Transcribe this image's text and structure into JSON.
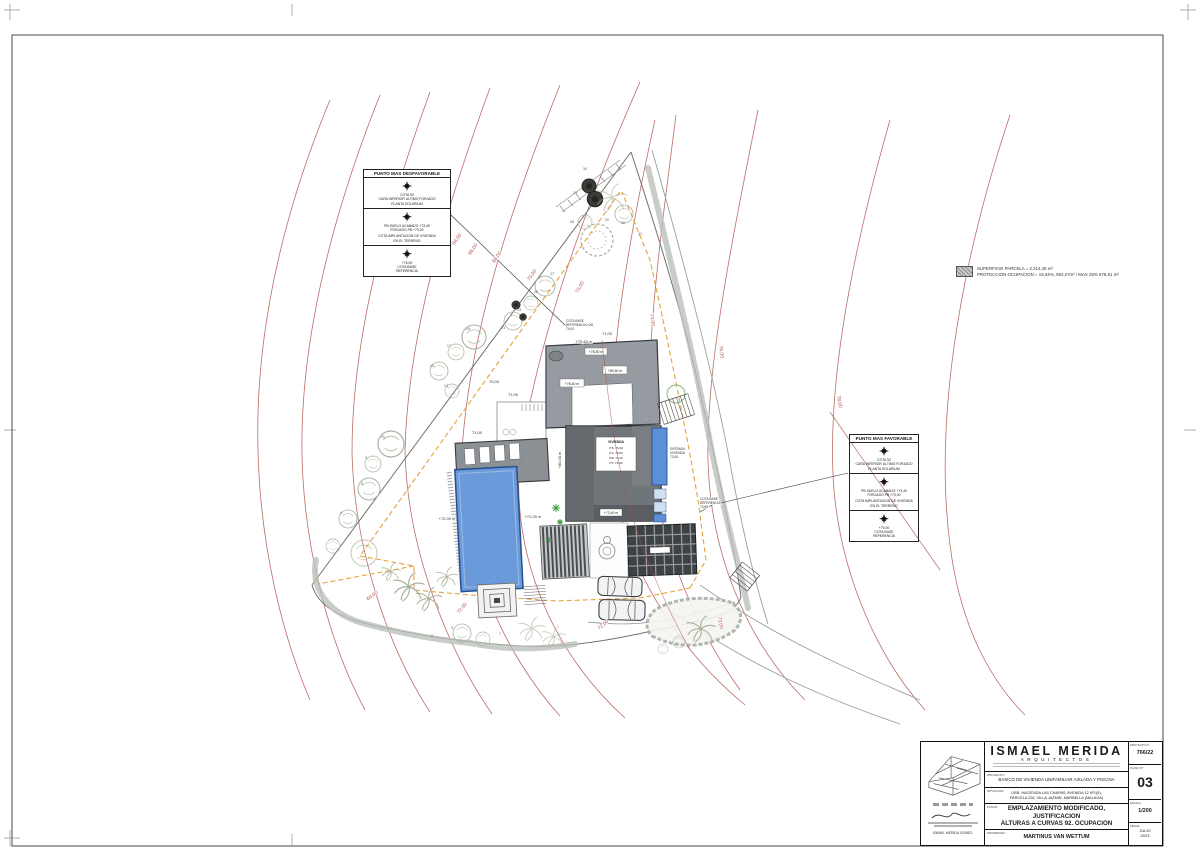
{
  "sheet": {
    "legend": {
      "line1": "SUPERFICIE PARCELA = 2.314,45 m²",
      "line2": "PROTECCION OCUPACION = 19,34%, 592,27m² / MAX 25% 578,61 m²"
    },
    "box_left": {
      "title": "PUNTO MAS DESFAVORABLE",
      "cell1": {
        "l1": "COTA 92",
        "l2": "CARA INFERIOR ULTIMO FORJADO",
        "l3": "PLANTA SOLARIUM"
      },
      "cell2": {
        "l1": "PB SUELO ACABADO +73,40",
        "l2": "FORJADO PB +73,00",
        "l3": "COTA IMPLANTACION DE VIVIENDA",
        "l4": "EN EL TERRENO"
      },
      "cell3": {
        "l1": "+75,00",
        "l2": "COTA BASE",
        "l3": "REFERENCIA"
      }
    },
    "box_right": {
      "title": "PUNTO MAS FAVORABLE",
      "cell1": {
        "l1": "COTA 92",
        "l2": "CARA INFERIOR ULTIMO FORJADO",
        "l3": "PLANTA SOLARIUM"
      },
      "cell2": {
        "l1": "PB SUELO ACABADO +73,40",
        "l2": "FORJADO PB +73,00",
        "l3": "COTA IMPLANTACION DE VIVIENDA",
        "l4": "EN EL TERRENO"
      },
      "cell3": {
        "l1": "+75,00",
        "l2": "COTA BASE",
        "l3": "REFERENCIA"
      }
    },
    "title_block": {
      "brand": "ISMAEL MERIDA",
      "brand_sub": "ARQUITECTOS",
      "architect_name": "ISMAEL MERIDA GOMEZ",
      "rows": {
        "proyecto_label": "PROYECTO:",
        "proyecto_value": "BASICO DE VIVIENDA UNIFAMILIAR AISLADA Y PISCINA",
        "situacion_label": "SITUACION:",
        "situacion_l1": "URB. HACIENDA LAS CHAPAS, AVENIDA 12 Nº1(5),",
        "situacion_l2": "PARCELA 226, VILLA JAZMIN, MARBELLA (MALAGA)",
        "plano_label": "PLANO:",
        "plano_l1": "EMPLAZAMIENTO MODIFICADO, JUSTIFICACION",
        "plano_l2": "ALTURAS A CURVAS 92. OCUPACION",
        "propiedad_label": "PROPIEDAD:",
        "propiedad_value": "MARTINUS VAN WETTUM"
      },
      "meta": {
        "proyecto_no_label": "PROYECTO Nº",
        "proyecto_no": "766/22",
        "plano_no_label": "PLANO Nº",
        "plano_no": "03",
        "escala_label": "ESCALA",
        "escala": "1/200",
        "fecha_label": "FECHA",
        "fecha_l1": "JULIO",
        "fecha_l2": "2023"
      }
    }
  },
  "plan": {
    "contour_labels": {
      "c64": "64,00",
      "c66": "66,00",
      "c68": "68,00",
      "c70": "70,00",
      "c73": "73,00",
      "c74": "74,00",
      "c76": "76,00",
      "c78": "78,00",
      "c72a": "72,00",
      "c72b": "72,00",
      "c69": "69,00",
      "c73b": "73,00"
    },
    "spot_labels": {
      "s70": "70,00",
      "s71a": "71,00",
      "s7563": "+75,63 m",
      "s7650": "+76,50 m",
      "s8060": "+80,60 m",
      "s7640": "+76,40 m",
      "s8000": "+80,00 m",
      "s72l": "+72,00 m",
      "s72r": "+72,00 m",
      "s7340": "+73,40 m",
      "s71b": "71,00",
      "s70b": "70,00",
      "s71c": "71,00"
    },
    "notes": {
      "ref1_l1": "COTA BASE",
      "ref1_l2": "REFERENCIA",
      "ref1_l3": "74,00",
      "ref2_l1": "COTA BASE",
      "ref2_l2": "REFERENCIA",
      "ref2_l3": "73,85",
      "ent_l1": "ENTRADA",
      "ent_l2": "VIVIENDA",
      "ent_l3": "73,06"
    },
    "vivienda_box": {
      "l1": "VIVIENDA",
      "l2": "P.S. 76,40",
      "l3": "P.A. 76,00",
      "l4": "P.B. 73,40",
      "l5": "P.T. 72,00"
    },
    "tree_numbers": {
      "n2": "2",
      "n3": "3",
      "n4": "4",
      "n5": "5",
      "n7": "7",
      "n9": "9",
      "n11": "11",
      "n13": "13",
      "n15": "15",
      "n17": "17",
      "n19": "19",
      "n21": "21",
      "n23": "23",
      "n25": "25",
      "n27": "27",
      "n28": "28",
      "n30": "30",
      "n31": "31",
      "n32": "32",
      "n33": "33",
      "n34": "34"
    }
  },
  "colors": {
    "contour": "#b0524c",
    "setback": "#e3a33c",
    "pool": "#5b8fd6",
    "roof": "#9aa0a5"
  }
}
